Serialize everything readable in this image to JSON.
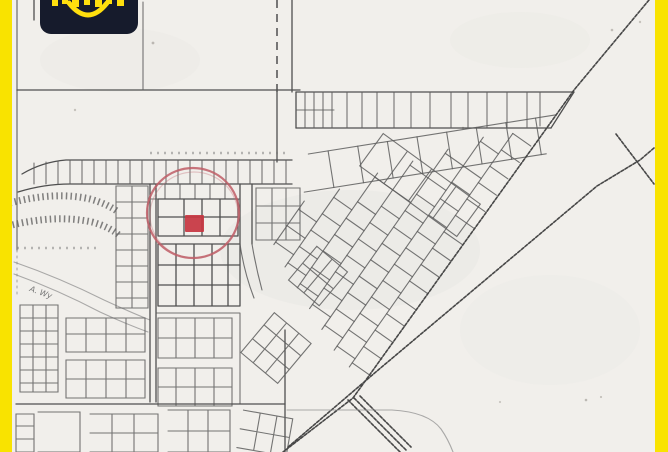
{
  "frame": {
    "color": "#f9e300",
    "left_width": 12,
    "right_width": 13
  },
  "logo": {
    "badge_color": "#161b2c",
    "accent_color": "#ffdf0e",
    "icon": "smile-logo",
    "text_visible_fully": false
  },
  "map": {
    "kind": "scanned cadastral plat map",
    "paper_color": "#f1efeb",
    "ink_color": "#4f4f4f",
    "street_labels": [
      {
        "text": "A. Wy"
      }
    ],
    "marker": {
      "shape": "highlight-circle-with-filled-lot",
      "circle_color": "#bf5d66",
      "square_color": "#c73540",
      "cx": 193,
      "cy": 213,
      "radius": 46
    }
  }
}
